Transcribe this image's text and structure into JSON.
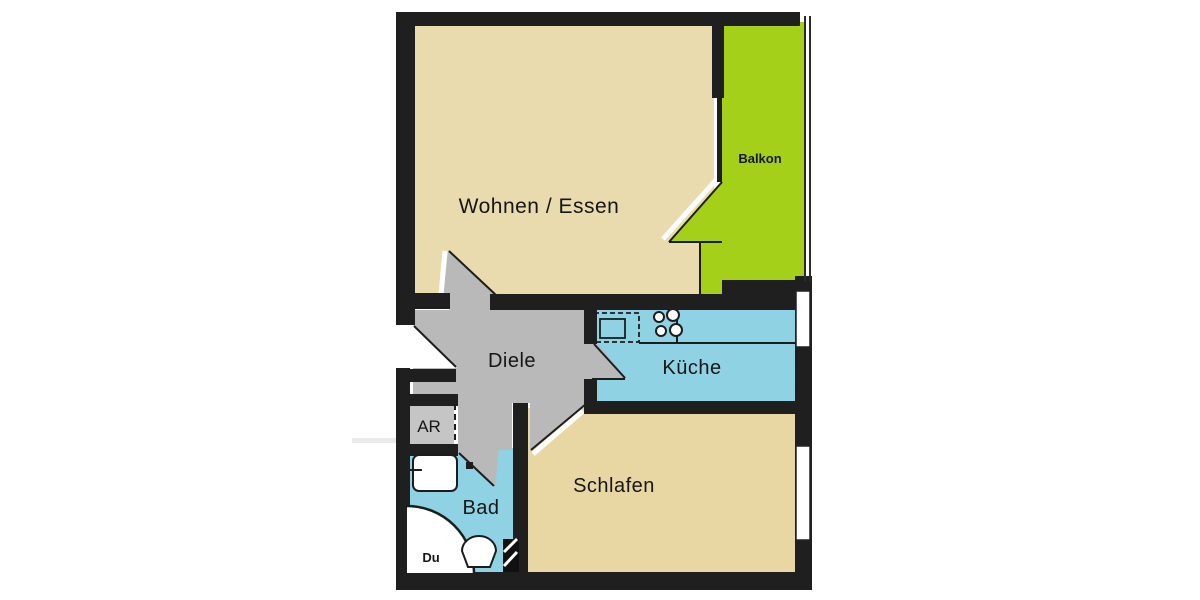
{
  "floorplan": {
    "background": "#ffffff",
    "wall_color": "#1f1f1f",
    "line_color": "#161616",
    "rooms": [
      {
        "id": "wohnen_essen",
        "label": "Wohnen / Essen",
        "color": "#e9dbad"
      },
      {
        "id": "balkon",
        "label": "Balkon",
        "color": "#a4d01a"
      },
      {
        "id": "diele",
        "label": "Diele",
        "color": "#b9b9b9"
      },
      {
        "id": "kueche",
        "label": "Küche",
        "color": "#8ed2e4"
      },
      {
        "id": "abstellraum",
        "label": "AR",
        "color": "#c5c5c5"
      },
      {
        "id": "bad",
        "label": "Bad",
        "color": "#8ed2e4"
      },
      {
        "id": "dusche",
        "label": "Du",
        "color": "#ffffff"
      },
      {
        "id": "schlafen",
        "label": "Schlafen",
        "color": "#e8d7a2"
      }
    ],
    "icons": [
      {
        "name": "kitchen-sink-icon"
      },
      {
        "name": "stove-burners-icon"
      },
      {
        "name": "washbasin-icon"
      },
      {
        "name": "toilet-icon"
      },
      {
        "name": "shower-quarter-circle-icon"
      },
      {
        "name": "shaft-hatch-icon"
      }
    ]
  }
}
